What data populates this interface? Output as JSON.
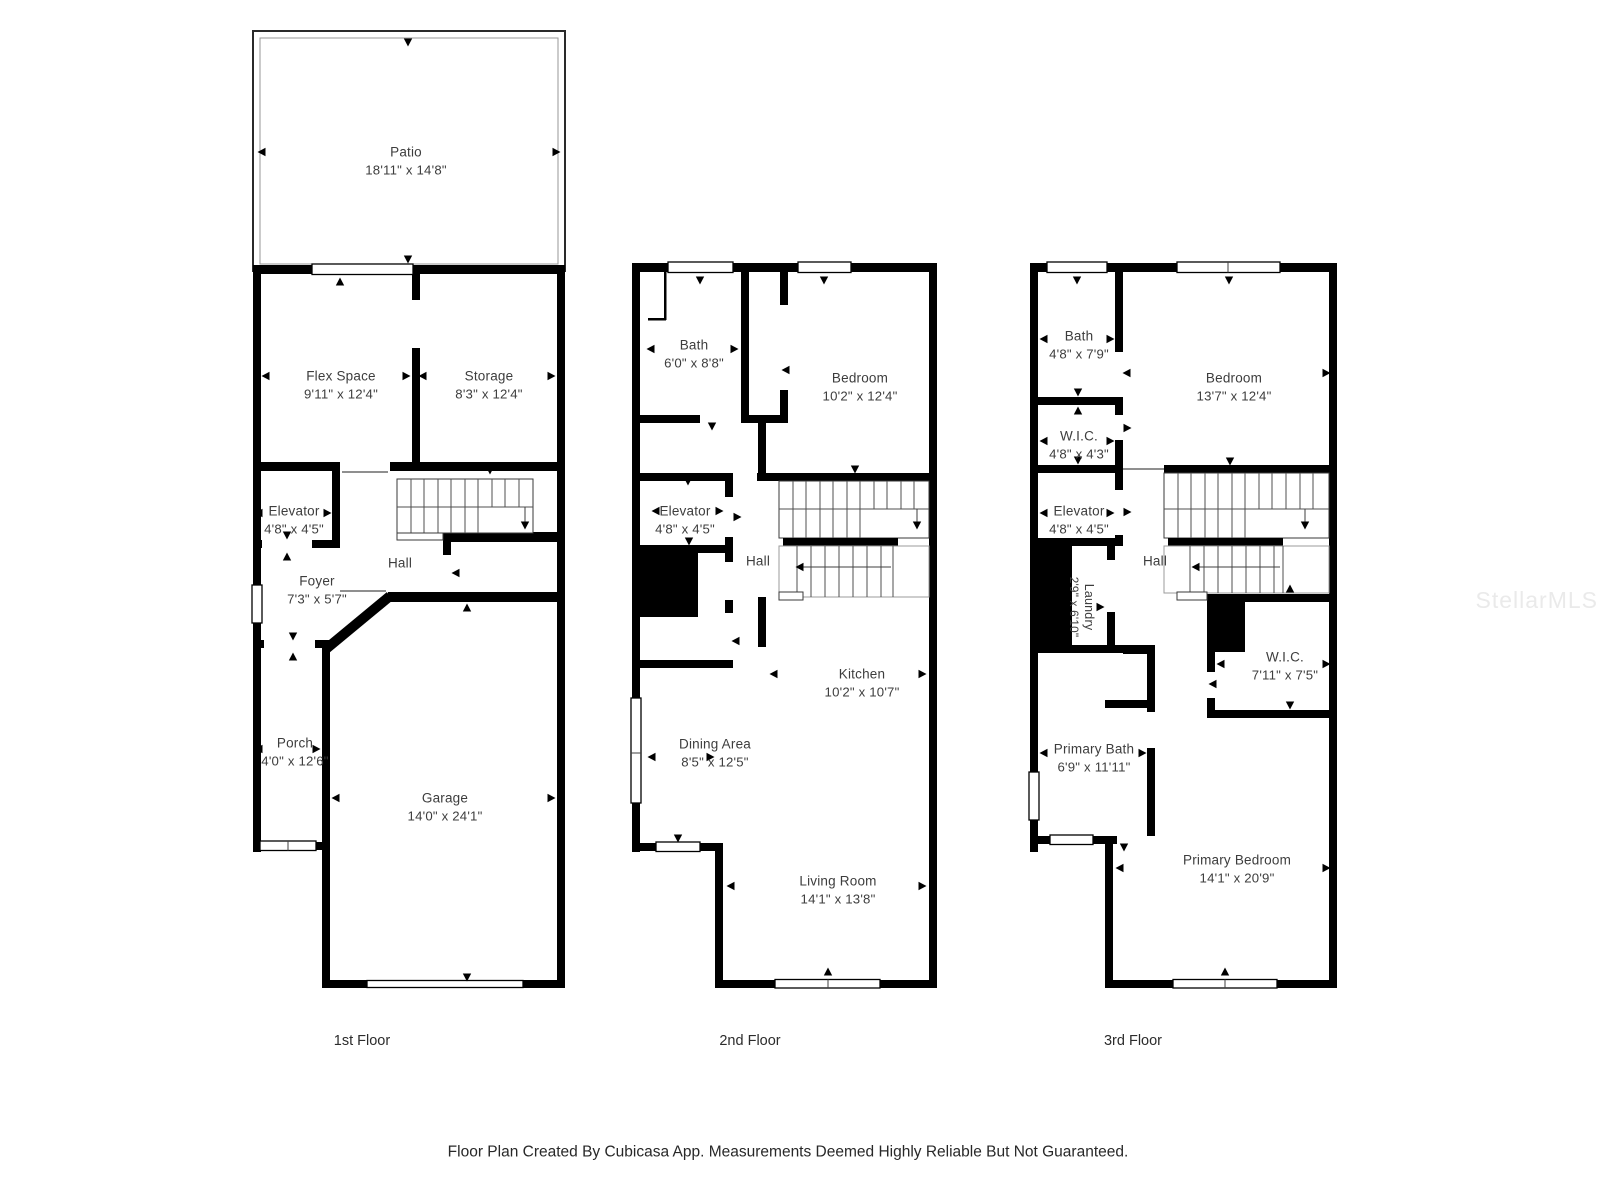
{
  "watermark": "StellarMLS",
  "caption": "Floor Plan Created By Cubicasa App. Measurements Deemed Highly Reliable But Not Guaranteed.",
  "colors": {
    "wall": "#000000",
    "text": "#3d3d3d",
    "watermark": "#eaeaea"
  },
  "floors": [
    {
      "label": "1st Floor",
      "rooms": {
        "patio": {
          "name": "Patio",
          "dims": "18'11\" x 14'8\""
        },
        "flex": {
          "name": "Flex Space",
          "dims": "9'11\" x 12'4\""
        },
        "storage": {
          "name": "Storage",
          "dims": "8'3\" x 12'4\""
        },
        "elevator": {
          "name": "Elevator",
          "dims": "4'8\" x 4'5\""
        },
        "hall": {
          "name": "Hall"
        },
        "foyer": {
          "name": "Foyer",
          "dims": "7'3\" x 5'7\""
        },
        "porch": {
          "name": "Porch",
          "dims": "4'0\" x 12'6\""
        },
        "garage": {
          "name": "Garage",
          "dims": "14'0\" x 24'1\""
        }
      }
    },
    {
      "label": "2nd Floor",
      "rooms": {
        "bath": {
          "name": "Bath",
          "dims": "6'0\" x 8'8\""
        },
        "bedroom": {
          "name": "Bedroom",
          "dims": "10'2\" x 12'4\""
        },
        "elevator": {
          "name": "Elevator",
          "dims": "4'8\" x 4'5\""
        },
        "hall": {
          "name": "Hall"
        },
        "kitchen": {
          "name": "Kitchen",
          "dims": "10'2\" x 10'7\""
        },
        "dining": {
          "name": "Dining Area",
          "dims": "8'5\" x 12'5\""
        },
        "living": {
          "name": "Living Room",
          "dims": "14'1\" x 13'8\""
        }
      }
    },
    {
      "label": "3rd Floor",
      "rooms": {
        "bath": {
          "name": "Bath",
          "dims": "4'8\" x 7'9\""
        },
        "bedroom": {
          "name": "Bedroom",
          "dims": "13'7\" x 12'4\""
        },
        "wic1": {
          "name": "W.I.C.",
          "dims": "4'8\" x 4'3\""
        },
        "elevator": {
          "name": "Elevator",
          "dims": "4'8\" x 4'5\""
        },
        "laundry": {
          "name": "Laundry",
          "dims": "2'9\" x 6'10\""
        },
        "hall": {
          "name": "Hall"
        },
        "wic2": {
          "name": "W.I.C.",
          "dims": "7'11\" x 7'5\""
        },
        "pbath": {
          "name": "Primary Bath",
          "dims": "6'9\" x 11'11\""
        },
        "pbed": {
          "name": "Primary Bedroom",
          "dims": "14'1\" x 20'9\""
        }
      }
    }
  ]
}
